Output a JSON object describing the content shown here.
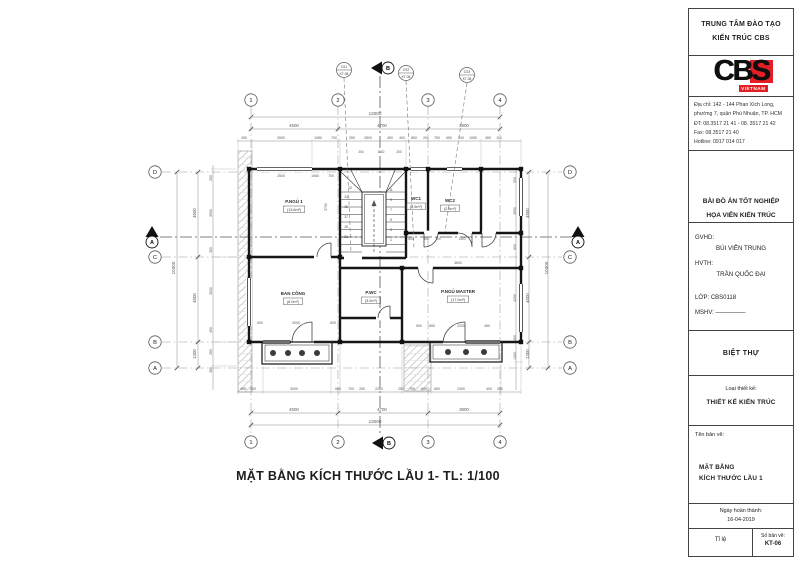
{
  "title_block": {
    "header_line1": "TRUNG TÂM ĐÀO TẠO",
    "header_line2": "KIẾN TRÚC CBS",
    "logo": {
      "letters": "CBS",
      "vietnam": "VIETNAM",
      "red": "#e31e24"
    },
    "address_lines": [
      "Địa chỉ: 142 - 144 Phan Xích Long,",
      "phường 7, quận Phú Nhuận, TP. HCM",
      "ĐT: 08.3517 21 41 - 08. 3517 21 42",
      "Fax: 08.3517 21 40",
      "Hotline: 0917 014 017"
    ],
    "project_line1": "BÀI ĐỒ ÁN TỐT NGHIỆP",
    "project_line2": "HỌA VIÊN KIẾN TRÚC",
    "gvhd_label": "GVHD:",
    "gvhd_name": "BÙI VIỄN TRUNG",
    "hvth_label": "HVTH:",
    "hvth_name": "TRẦN QUỐC ĐẠI",
    "class_line": "LỚP: CBS0118",
    "mshv_line": "MSHV: —————",
    "project_type": "BIỆT THỰ",
    "design_type_label": "Loại thiết kế:",
    "design_type": "THIẾT KẾ KIẾN TRÚC",
    "drawing_name_label": "Tên bản vẽ:",
    "drawing_name_line1": "MẶT BẰNG",
    "drawing_name_line2": "KÍCH THƯỚC LẦU 1",
    "date_label": "Ngày hoàn thành:",
    "date_value": "16-04-2019",
    "scale_label": "Tỉ lệ",
    "sheet_label": "Số bản vẽ:",
    "sheet_number": "KT-06"
  },
  "drawing": {
    "caption": "MẶT BẰNG KÍCH THƯỚC LẦU 1- TL: 1/100",
    "bubbles": [
      {
        "x": 251,
        "y": 100,
        "t": "1"
      },
      {
        "x": 338,
        "y": 100,
        "t": "2"
      },
      {
        "x": 428,
        "y": 100,
        "t": "3"
      },
      {
        "x": 500,
        "y": 100,
        "t": "4"
      },
      {
        "x": 251,
        "y": 442,
        "t": "1"
      },
      {
        "x": 338,
        "y": 442,
        "t": "2"
      },
      {
        "x": 428,
        "y": 442,
        "t": "3"
      },
      {
        "x": 500,
        "y": 442,
        "t": "4"
      },
      {
        "x": 155,
        "y": 172,
        "t": "D"
      },
      {
        "x": 155,
        "y": 257,
        "t": "C"
      },
      {
        "x": 155,
        "y": 342,
        "t": "B"
      },
      {
        "x": 155,
        "y": 368,
        "t": "A"
      },
      {
        "x": 570,
        "y": 172,
        "t": "D"
      },
      {
        "x": 570,
        "y": 257,
        "t": "C"
      },
      {
        "x": 570,
        "y": 342,
        "t": "B"
      },
      {
        "x": 570,
        "y": 368,
        "t": "A"
      }
    ],
    "markers": [
      {
        "x": 152,
        "y": 240,
        "t": "A",
        "o": "v"
      },
      {
        "x": 578,
        "y": 240,
        "t": "A",
        "o": "v"
      },
      {
        "x": 385,
        "y": 68,
        "t": "B",
        "o": "h"
      },
      {
        "x": 386,
        "y": 443,
        "t": "B",
        "o": "h"
      }
    ],
    "callouts": [
      {
        "x": 344,
        "y": 70,
        "a": "CS1",
        "b": "KT-08",
        "lx": 351,
        "ly": 252
      },
      {
        "x": 406,
        "y": 73,
        "a": "CS2",
        "b": "KT-08",
        "lx": 414,
        "ly": 248
      },
      {
        "x": 467,
        "y": 75,
        "a": "CS3",
        "b": "KT-08",
        "lx": 445,
        "ly": 232
      }
    ],
    "rooms": [
      {
        "x": 294,
        "y": 203,
        "name": "P.NGỦ 1",
        "area": "(13.6m²)"
      },
      {
        "x": 293,
        "y": 295,
        "name": "BAN CÔNG",
        "area": "(6.0m²)"
      },
      {
        "x": 371,
        "y": 294,
        "name": "P.WC",
        "area": "(3.0m²)"
      },
      {
        "x": 458,
        "y": 293,
        "name": "P.NGỦ MASTER",
        "area": "(17.0m²)"
      },
      {
        "x": 416,
        "y": 200,
        "name": "WC1",
        "area": "(2.5m²)"
      },
      {
        "x": 450,
        "y": 202,
        "name": "WC2",
        "area": "(2.5m²)"
      }
    ],
    "stair_numbers": [
      {
        "x": 350,
        "y": 189,
        "t": "12"
      },
      {
        "x": 346,
        "y": 198,
        "t": "13"
      },
      {
        "x": 346,
        "y": 208,
        "t": "15"
      },
      {
        "x": 346,
        "y": 218,
        "t": "17"
      },
      {
        "x": 346,
        "y": 228,
        "t": "19"
      },
      {
        "x": 346,
        "y": 238,
        "t": "21"
      },
      {
        "x": 391,
        "y": 191,
        "t": "11"
      },
      {
        "x": 391,
        "y": 201,
        "t": "9"
      },
      {
        "x": 391,
        "y": 211,
        "t": "7"
      },
      {
        "x": 391,
        "y": 221,
        "t": "5"
      },
      {
        "x": 391,
        "y": 231,
        "t": "3"
      },
      {
        "x": 391,
        "y": 241,
        "t": "1"
      }
    ],
    "dim_texts": [
      {
        "x": 375,
        "y": 115,
        "t": "13000",
        "s": 4.6
      },
      {
        "x": 294,
        "y": 127,
        "t": "4500",
        "s": 4.4
      },
      {
        "x": 382,
        "y": 127,
        "t": "4700",
        "s": 4.4
      },
      {
        "x": 464,
        "y": 127,
        "t": "3800",
        "s": 4.4
      },
      {
        "x": 244,
        "y": 139,
        "t": "450",
        "s": 3.5
      },
      {
        "x": 281,
        "y": 139,
        "t": "2500",
        "s": 3.5
      },
      {
        "x": 318,
        "y": 139,
        "t": "1080",
        "s": 3.5
      },
      {
        "x": 334,
        "y": 139,
        "t": "700",
        "s": 3.5
      },
      {
        "x": 352,
        "y": 139,
        "t": "250",
        "s": 3.5
      },
      {
        "x": 368,
        "y": 139,
        "t": "2800",
        "s": 3.5
      },
      {
        "x": 390,
        "y": 139,
        "t": "450",
        "s": 3.5
      },
      {
        "x": 402,
        "y": 139,
        "t": "400",
        "s": 3.5
      },
      {
        "x": 414,
        "y": 139,
        "t": "850",
        "s": 3.5
      },
      {
        "x": 426,
        "y": 139,
        "t": "200",
        "s": 3.5
      },
      {
        "x": 437,
        "y": 139,
        "t": "750",
        "s": 3.5
      },
      {
        "x": 449,
        "y": 139,
        "t": "650",
        "s": 3.5
      },
      {
        "x": 461,
        "y": 139,
        "t": "240",
        "s": 3.5
      },
      {
        "x": 473,
        "y": 139,
        "t": "1080",
        "s": 3.5
      },
      {
        "x": 488,
        "y": 139,
        "t": "450",
        "s": 3.5
      },
      {
        "x": 499,
        "y": 139,
        "t": "100",
        "s": 3.5
      },
      {
        "x": 281,
        "y": 177,
        "t": "2500",
        "s": 3.5
      },
      {
        "x": 315,
        "y": 177,
        "t": "1080",
        "s": 3.5
      },
      {
        "x": 331,
        "y": 177,
        "t": "700",
        "s": 3.5
      },
      {
        "x": 327,
        "y": 207,
        "t": "3700",
        "s": 3.5,
        "r": -90
      },
      {
        "x": 361,
        "y": 153,
        "t": "250",
        "s": 3.2
      },
      {
        "x": 381,
        "y": 153,
        "t": "1130",
        "s": 3.2
      },
      {
        "x": 399,
        "y": 153,
        "t": "250",
        "s": 3.2
      },
      {
        "x": 411,
        "y": 240,
        "t": "800",
        "s": 3.2
      },
      {
        "x": 426,
        "y": 240,
        "t": "800",
        "s": 3.2
      },
      {
        "x": 438,
        "y": 240,
        "t": "100",
        "s": 3.2
      },
      {
        "x": 462,
        "y": 240,
        "t": "1400",
        "s": 3.2
      },
      {
        "x": 260,
        "y": 324,
        "t": "600",
        "s": 3.5
      },
      {
        "x": 296,
        "y": 324,
        "t": "3000",
        "s": 3.5
      },
      {
        "x": 333,
        "y": 324,
        "t": "600",
        "s": 3.5
      },
      {
        "x": 419,
        "y": 327,
        "t": "500",
        "s": 3.5
      },
      {
        "x": 432,
        "y": 327,
        "t": "650",
        "s": 3.5
      },
      {
        "x": 461,
        "y": 327,
        "t": "2300",
        "s": 3.5
      },
      {
        "x": 487,
        "y": 327,
        "t": "450",
        "s": 3.5
      },
      {
        "x": 458,
        "y": 264,
        "t": "3600",
        "s": 3.5
      },
      {
        "x": 243,
        "y": 390,
        "t": "450",
        "s": 3.5
      },
      {
        "x": 253,
        "y": 390,
        "t": "250",
        "s": 3.5
      },
      {
        "x": 294,
        "y": 390,
        "t": "3000",
        "s": 3.5
      },
      {
        "x": 338,
        "y": 390,
        "t": "600",
        "s": 3.5
      },
      {
        "x": 351,
        "y": 390,
        "t": "700",
        "s": 3.5
      },
      {
        "x": 362,
        "y": 390,
        "t": "250",
        "s": 3.5
      },
      {
        "x": 379,
        "y": 390,
        "t": "2260",
        "s": 3.5
      },
      {
        "x": 401,
        "y": 390,
        "t": "250",
        "s": 3.5
      },
      {
        "x": 412,
        "y": 390,
        "t": "700",
        "s": 3.5
      },
      {
        "x": 424,
        "y": 390,
        "t": "500",
        "s": 3.5
      },
      {
        "x": 437,
        "y": 390,
        "t": "650",
        "s": 3.5
      },
      {
        "x": 461,
        "y": 390,
        "t": "2300",
        "s": 3.5
      },
      {
        "x": 489,
        "y": 390,
        "t": "400",
        "s": 3.5
      },
      {
        "x": 500,
        "y": 390,
        "t": "250",
        "s": 3.5
      },
      {
        "x": 294,
        "y": 411,
        "t": "4500",
        "s": 4.4
      },
      {
        "x": 382,
        "y": 411,
        "t": "4700",
        "s": 4.4
      },
      {
        "x": 464,
        "y": 411,
        "t": "3800",
        "s": 4.4
      },
      {
        "x": 375,
        "y": 423,
        "t": "13000",
        "s": 4.6
      },
      {
        "x": 175,
        "y": 268,
        "t": "10300",
        "s": 4.6,
        "r": -90
      },
      {
        "x": 196,
        "y": 213,
        "t": "4500",
        "s": 4.4,
        "r": -90
      },
      {
        "x": 196,
        "y": 298,
        "t": "4500",
        "s": 4.4,
        "r": -90
      },
      {
        "x": 196,
        "y": 354,
        "t": "1300",
        "s": 4.4,
        "r": -90
      },
      {
        "x": 212,
        "y": 178,
        "t": "250",
        "s": 3.5,
        "r": -90
      },
      {
        "x": 212,
        "y": 213,
        "t": "3950",
        "s": 3.5,
        "r": -90
      },
      {
        "x": 212,
        "y": 250,
        "t": "300",
        "s": 3.5,
        "r": -90
      },
      {
        "x": 212,
        "y": 291,
        "t": "3000",
        "s": 3.5,
        "r": -90
      },
      {
        "x": 212,
        "y": 330,
        "t": "450",
        "s": 3.5,
        "r": -90
      },
      {
        "x": 212,
        "y": 352,
        "t": "250",
        "s": 3.5,
        "r": -90
      },
      {
        "x": 212,
        "y": 370,
        "t": "380",
        "s": 3.5,
        "r": -90
      },
      {
        "x": 548,
        "y": 268,
        "t": "10300",
        "s": 4.6,
        "r": -90
      },
      {
        "x": 529,
        "y": 213,
        "t": "4500",
        "s": 4.4,
        "r": -90
      },
      {
        "x": 529,
        "y": 298,
        "t": "4500",
        "s": 4.4,
        "r": -90
      },
      {
        "x": 529,
        "y": 354,
        "t": "1300",
        "s": 4.4,
        "r": -90
      },
      {
        "x": 516,
        "y": 180,
        "t": "550",
        "s": 3.5,
        "r": -90
      },
      {
        "x": 516,
        "y": 211,
        "t": "3950",
        "s": 3.5,
        "r": -90
      },
      {
        "x": 516,
        "y": 247,
        "t": "600",
        "s": 3.5,
        "r": -90
      },
      {
        "x": 516,
        "y": 298,
        "t": "4250",
        "s": 3.5,
        "r": -90
      },
      {
        "x": 516,
        "y": 338,
        "t": "450",
        "s": 3.5,
        "r": -90
      },
      {
        "x": 516,
        "y": 356,
        "t": "1300",
        "s": 3.5,
        "r": -90
      }
    ]
  }
}
